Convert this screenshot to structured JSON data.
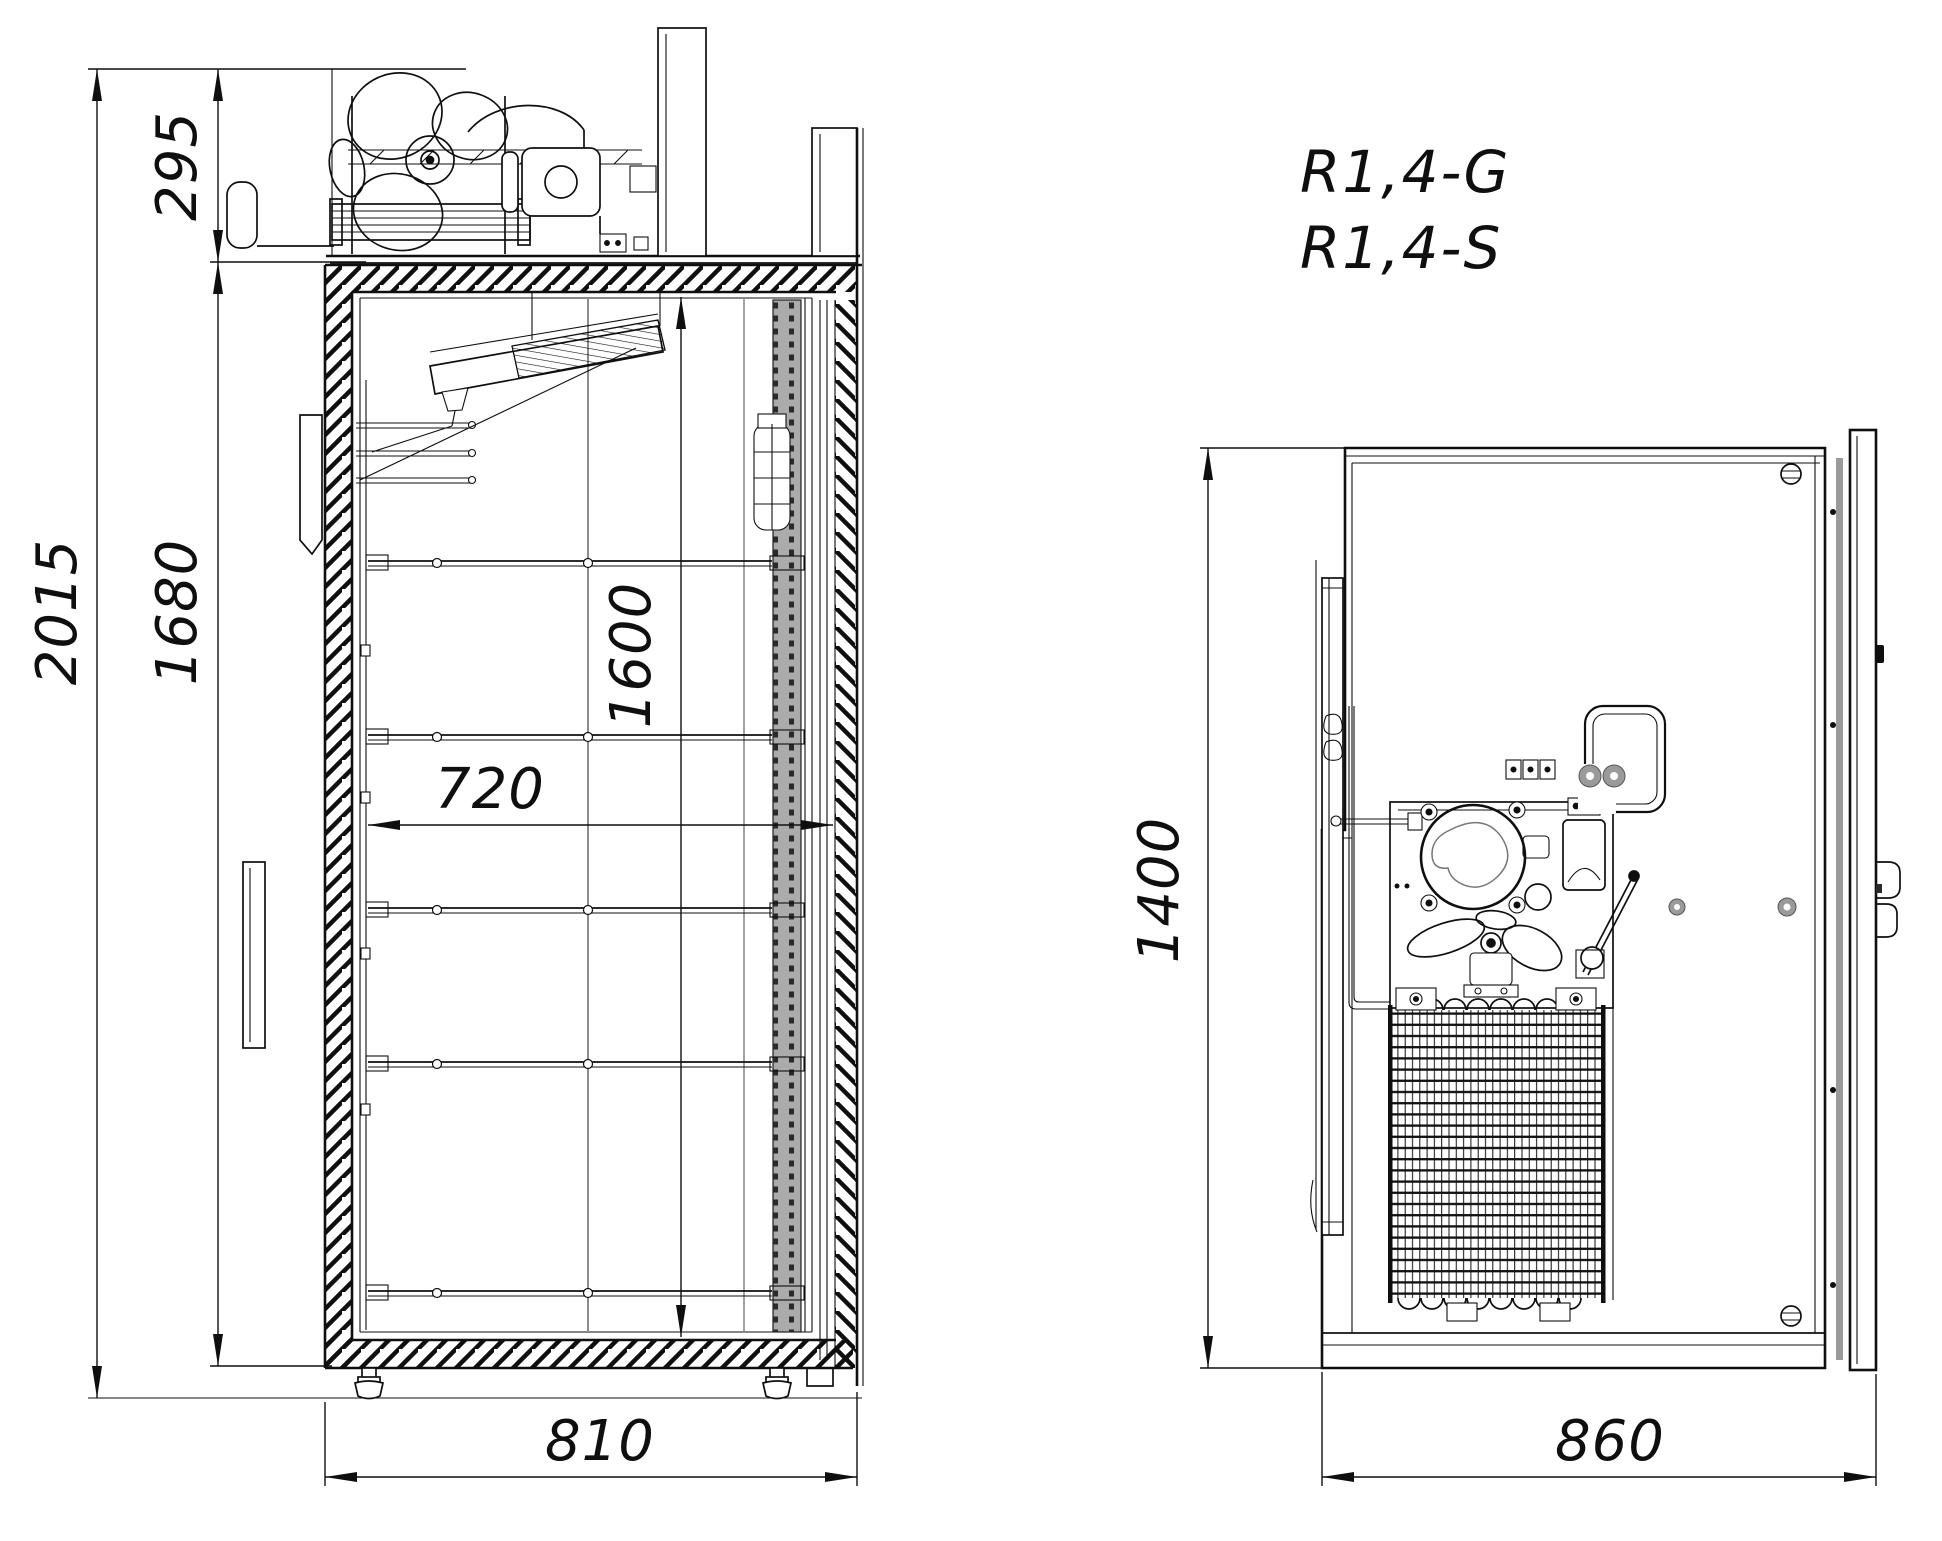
{
  "page": {
    "background": "#ffffff",
    "type": "technical-dimension-drawing",
    "views": [
      "side-section",
      "top-plan"
    ]
  },
  "labels": {
    "models": [
      "R1,4-G",
      "R1,4-S"
    ]
  },
  "side_view": {
    "dimensions": {
      "overall_height": "2015",
      "machinery_height": "295",
      "interior_height": "1680",
      "clear_height": "1600",
      "interior_depth": "720",
      "body_depth": "810"
    }
  },
  "top_view": {
    "dimensions": {
      "overall_width": "1400",
      "overall_depth": "860"
    }
  },
  "colors": {
    "line": "#0f0f0f",
    "gray_part": "#9a9a9a",
    "rail_gray": "#ababab",
    "hole_dark": "#2a2a2a",
    "background": "#ffffff"
  }
}
